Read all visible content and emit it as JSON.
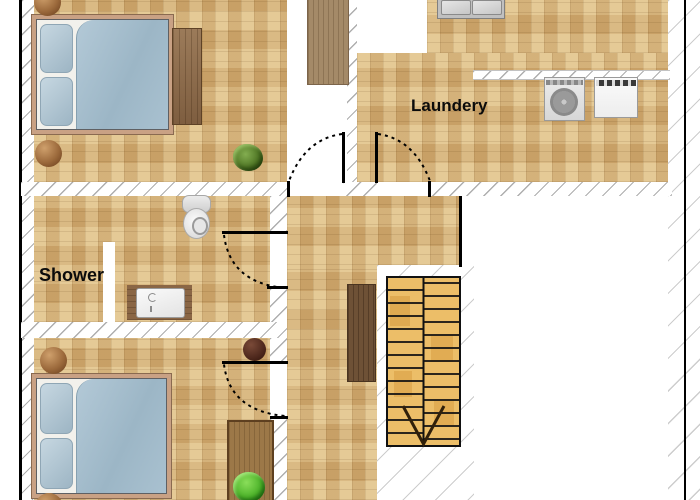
{
  "rooms": {
    "laundry": {
      "label": "Laundery"
    },
    "bathroom": {
      "label": "Shower"
    }
  },
  "fixtures": [
    "double-bed-icon",
    "double-bed-icon",
    "nightstand-icon",
    "nightstand-icon",
    "nightstand-icon",
    "nightstand-icon",
    "stool-icon",
    "desk-icon",
    "wardrobe-plank-icon",
    "sideboard-icon",
    "closet-icon",
    "plant-icon",
    "bush-icon",
    "toilet-icon",
    "vanity-sink-icon",
    "kitchen-sink-icon",
    "washing-machine-icon",
    "dryer-icon",
    "staircase-down-icon",
    "door-swing-icon",
    "door-swing-icon",
    "door-swing-icon",
    "door-swing-icon"
  ],
  "colors": {
    "floor": "#d9b67c",
    "wall_hatch_gray": "#787878",
    "wall_line": "#000000",
    "wood_brown": "#8a6848",
    "stair_wood": "#ecbe68",
    "bed_blue": "#a6c0d0",
    "plant_green": "#4d7423",
    "bush_green": "#4db32a"
  }
}
